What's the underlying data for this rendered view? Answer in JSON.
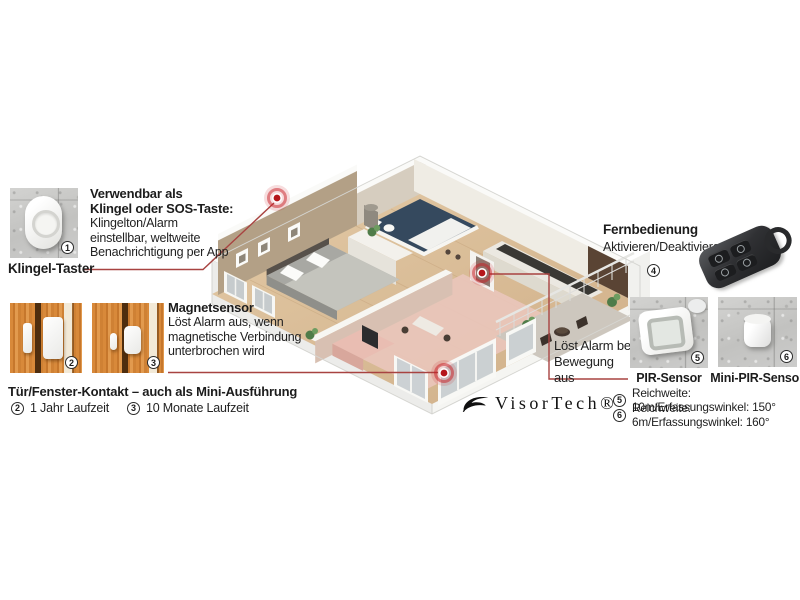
{
  "brand": {
    "name": "VisorTech®"
  },
  "doorbell": {
    "label": "Klingel-Taster",
    "badge": "1",
    "bold_lines": [
      "Verwendbar als",
      "Klingel oder SOS-Taste:"
    ],
    "lines": [
      "Klingelton/Alarm",
      "einstellbar, weltweite",
      "Benachrichtigung per App"
    ]
  },
  "magnet": {
    "heading": "Magnetsensor",
    "lines": [
      "Löst Alarm aus, wenn",
      "magnetische Verbindung",
      "unterbrochen wird"
    ],
    "title": "Tür/Fenster-Kontakt – auch als Mini-Ausführung",
    "variants": [
      {
        "badge": "2",
        "text": "1 Jahr Laufzeit"
      },
      {
        "badge": "3",
        "text": "10 Monate Laufzeit"
      }
    ]
  },
  "remote": {
    "heading": "Fernbedienung",
    "subtext": "Aktivieren/Deaktivieren",
    "badge": "4"
  },
  "motion": {
    "callout_lines": [
      "Löst Alarm bei",
      "Bewegung aus"
    ],
    "sensors": [
      {
        "badge": "5",
        "label": "PIR-Sensor"
      },
      {
        "badge": "6",
        "label": "Mini-PIR-Sensor"
      }
    ],
    "specs": [
      {
        "badge": "5",
        "text": "Reichweite: 10m/Erfassungswinkel: 150°"
      },
      {
        "badge": "6",
        "text": "Reichweite: 6m/Erfassungswinkel: 160°"
      }
    ]
  },
  "colors": {
    "accent_red": "#a84341",
    "alarm_red": "#b5161b",
    "floor_wood": "#d9bd99",
    "living_pink": "#e9c6bb",
    "bath_navy": "#35495e",
    "wall_tan": "#b3a086"
  }
}
